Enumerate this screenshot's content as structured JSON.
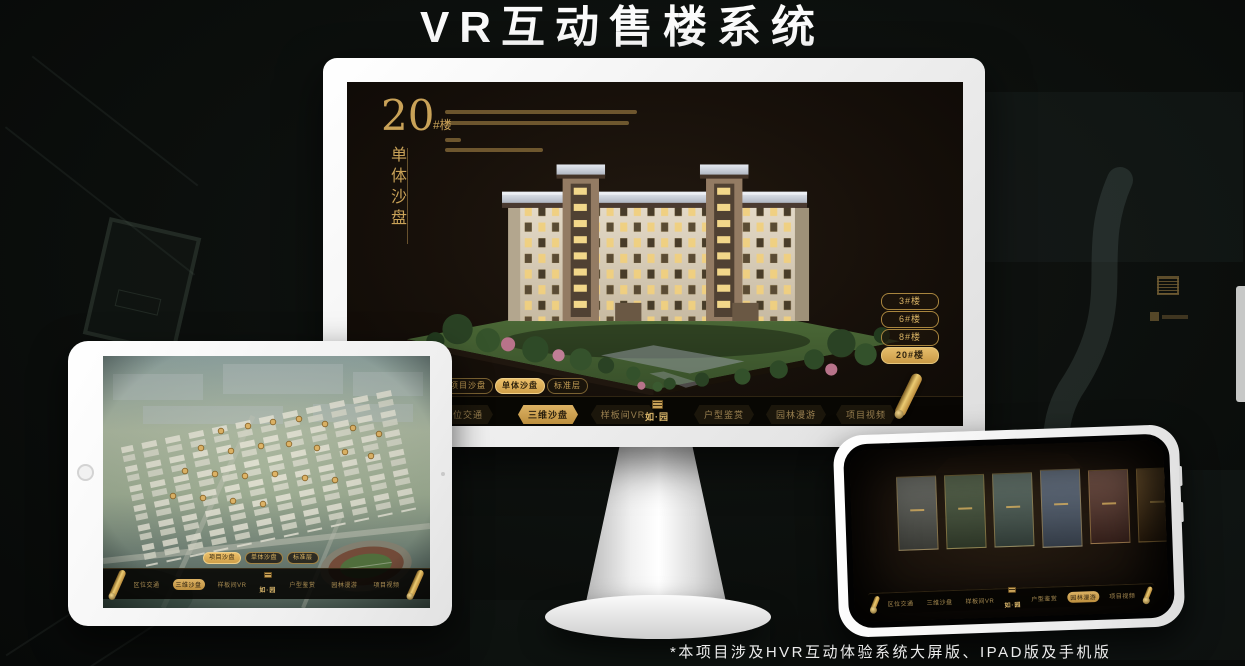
{
  "page": {
    "title": "VR互动售楼系统",
    "footnote": "*本项目涉及HVR互动体验系统大屏版、IPAD版及手机版"
  },
  "colors": {
    "gold": "#c9a258",
    "gold_bright": "#e0b45f",
    "screen_bg": "#17100a",
    "background": "#0b0e0c"
  },
  "desktop_app": {
    "headline": {
      "number": "20",
      "suffix": "#楼",
      "subtitle_vertical": "单体沙盘"
    },
    "floor_buttons": [
      {
        "label": "3#楼",
        "selected": false
      },
      {
        "label": "6#楼",
        "selected": false
      },
      {
        "label": "8#楼",
        "selected": false
      },
      {
        "label": "20#楼",
        "selected": true
      }
    ],
    "view_tabs": [
      {
        "label": "项目沙盘",
        "selected": false
      },
      {
        "label": "单体沙盘",
        "selected": true
      },
      {
        "label": "标准层",
        "selected": false
      }
    ],
    "nav": {
      "logo": "如·园",
      "items": [
        {
          "label": "区位交通",
          "selected": false
        },
        {
          "label": "三维沙盘",
          "selected": true
        },
        {
          "label": "样板间VR",
          "selected": false
        },
        {
          "label": "户型鉴赏",
          "selected": false
        },
        {
          "label": "园林漫游",
          "selected": false
        },
        {
          "label": "项目视频",
          "selected": false
        }
      ]
    }
  },
  "tablet_app": {
    "view_tabs": [
      {
        "label": "项目沙盘",
        "selected": true
      },
      {
        "label": "单体沙盘",
        "selected": false
      },
      {
        "label": "标准层",
        "selected": false
      }
    ],
    "nav": {
      "logo": "如·园",
      "items": [
        {
          "label": "区位交通",
          "selected": false
        },
        {
          "label": "三维沙盘",
          "selected": true
        },
        {
          "label": "样板间VR",
          "selected": false
        },
        {
          "label": "户型鉴赏",
          "selected": false
        },
        {
          "label": "园林漫游",
          "selected": false
        },
        {
          "label": "项目视频",
          "selected": false
        }
      ]
    }
  },
  "phone_app": {
    "nav": {
      "logo": "如·园",
      "items": [
        {
          "label": "区位交通",
          "selected": false
        },
        {
          "label": "三维沙盘",
          "selected": false
        },
        {
          "label": "样板间VR",
          "selected": false
        },
        {
          "label": "户型鉴赏",
          "selected": false
        },
        {
          "label": "园林漫游",
          "selected": true
        },
        {
          "label": "项目视频",
          "selected": false
        }
      ]
    },
    "gallery_panels": [
      {
        "name": "panel-1",
        "color": "#5e605a"
      },
      {
        "name": "panel-2",
        "color": "#46523f"
      },
      {
        "name": "panel-3",
        "color": "#4f5f58"
      },
      {
        "name": "panel-4",
        "color": "#515c68"
      },
      {
        "name": "panel-5",
        "color": "#5c4038"
      },
      {
        "name": "panel-6",
        "color": "#5e4426"
      }
    ]
  }
}
